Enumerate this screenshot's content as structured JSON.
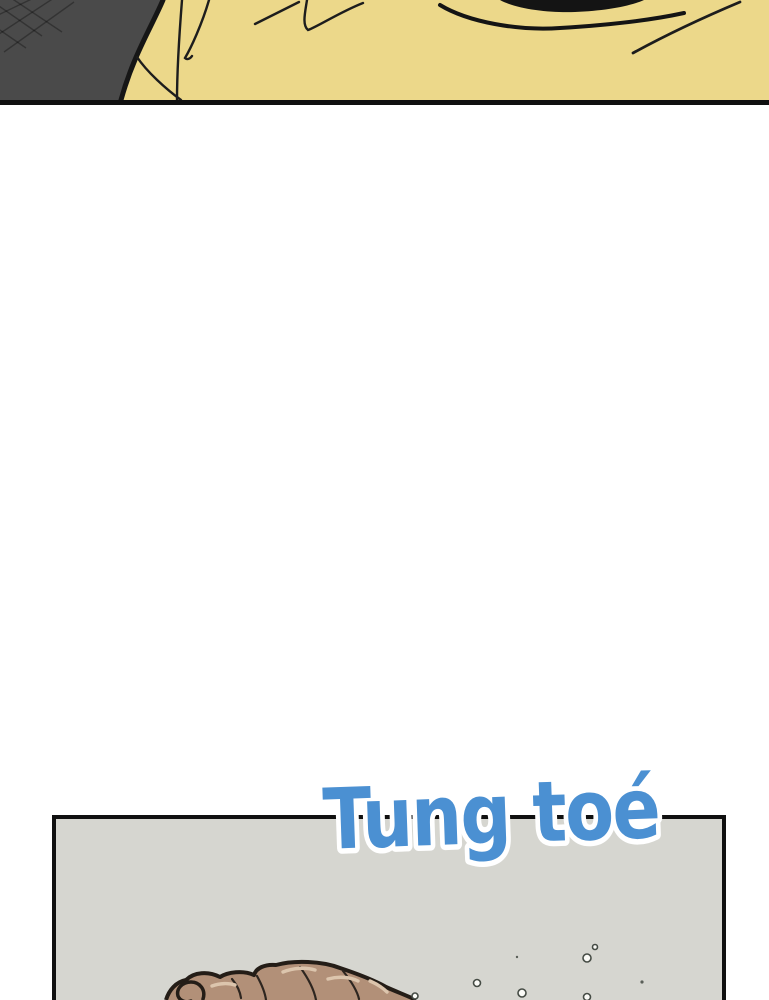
{
  "page": {
    "kind": "webtoon-comic-strip",
    "background_color": "#ffffff"
  },
  "sfx": {
    "text": "Tung toé",
    "color": "#4b90d2",
    "outline_color": "#ffffff"
  },
  "panels": {
    "top": {
      "description": "close-up of a yellow shirt with dark grey jacket shoulder and black collar opening",
      "shirt_color": "#ecd88a",
      "jacket_color": "#4a4a4a",
      "fold_line_color": "#1d1d1d",
      "collar_color": "#141414",
      "border_color": "#101010"
    },
    "bottom": {
      "description": "grey panel showing the top of a brown-haired head surfacing with water droplets",
      "background_color": "#d6d6d0",
      "border_color": "#101010",
      "hair_color": "#b29078",
      "hair_outline_color": "#241d17",
      "hair_highlight_color": "#dcc5ad",
      "droplet_fill": "#fbfbf7",
      "droplet_stroke": "#454b44"
    }
  }
}
